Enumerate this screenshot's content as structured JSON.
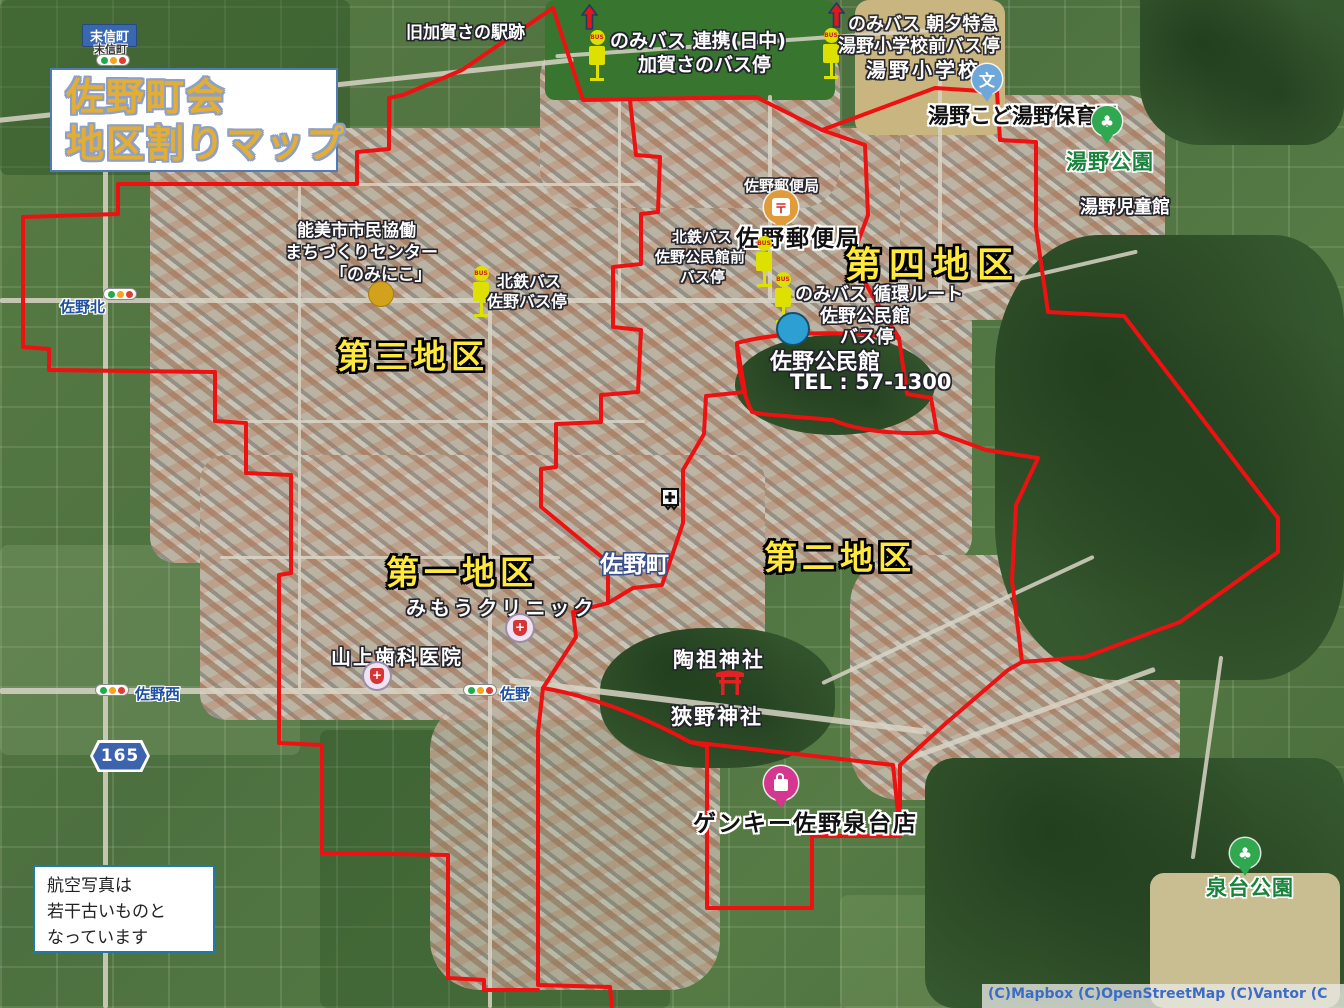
{
  "colors": {
    "boundary": "#ee1111",
    "district": "#ffe93c",
    "title": "#e2ae35"
  },
  "icons": {
    "bus_text": "BUS",
    "school_text": "文",
    "post_text": "〒",
    "hospital_text": "+",
    "park_text": "♣"
  },
  "title": {
    "line1": "佐野町会",
    "line2": "地区割りマップ"
  },
  "note": {
    "line1": "航空写真は",
    "line2": "若干古いものと",
    "line3": "なっています"
  },
  "attribution": "(C)Mapbox  (C)OpenStreetMap  (C)Vantor  (C",
  "districts": {
    "d1": "第一地区",
    "d2": "第二地区",
    "d3": "第三地区",
    "d4": "第四地区"
  },
  "places": {
    "suenobu_sign": "末信町",
    "suenobu_small": "末信町",
    "kyukaga": "旧加賀さの駅跡",
    "yuno_elementary": "湯野小学校",
    "yuno_kodomoen": "湯野こど湯野保育園",
    "yuno_park": "湯野公園",
    "yuno_jidokan": "湯野児童館",
    "post_office_small": "佐野郵便局",
    "post_office": "佐野郵便局",
    "koominkan": "佐野公民館",
    "koominkan_tel": "TEL : 57-1300",
    "center_l1": "能美市市民協働",
    "center_l2": "まちづくりセンター",
    "center_l3": "「のみにこ」",
    "sanokita": "佐野北",
    "sanomachi": "佐野町",
    "mimou_clinic": "みもうクリニック",
    "yamagami_dental": "山上歯科医院",
    "sanonishi": "佐野西",
    "sano": "佐野",
    "route": "165",
    "toso_jinja": "陶祖神社",
    "sano_jinja": "狹野神社",
    "genky": "ゲンキー佐野泉台店",
    "izumidai_park": "泉台公園"
  },
  "bus_stops": {
    "kagasano_l1": "のみバス 連携(日中)",
    "kagasano_l2": "加賀さのバス停",
    "yunosho_l1": "のみバス 朝夕特急",
    "yunosho_l2": "湯野小学校前バス停",
    "koominkanmae_l1": "北鉄バス",
    "koominkanmae_l2": "佐野公民館前",
    "koominkanmae_l3": "バス停",
    "junkan_l1": "のみバス 循環ルート",
    "junkan_l2": "佐野公民館",
    "junkan_l3": "バス停",
    "sano_l1": "北鉄バス",
    "sano_l2": "佐野バス停"
  }
}
